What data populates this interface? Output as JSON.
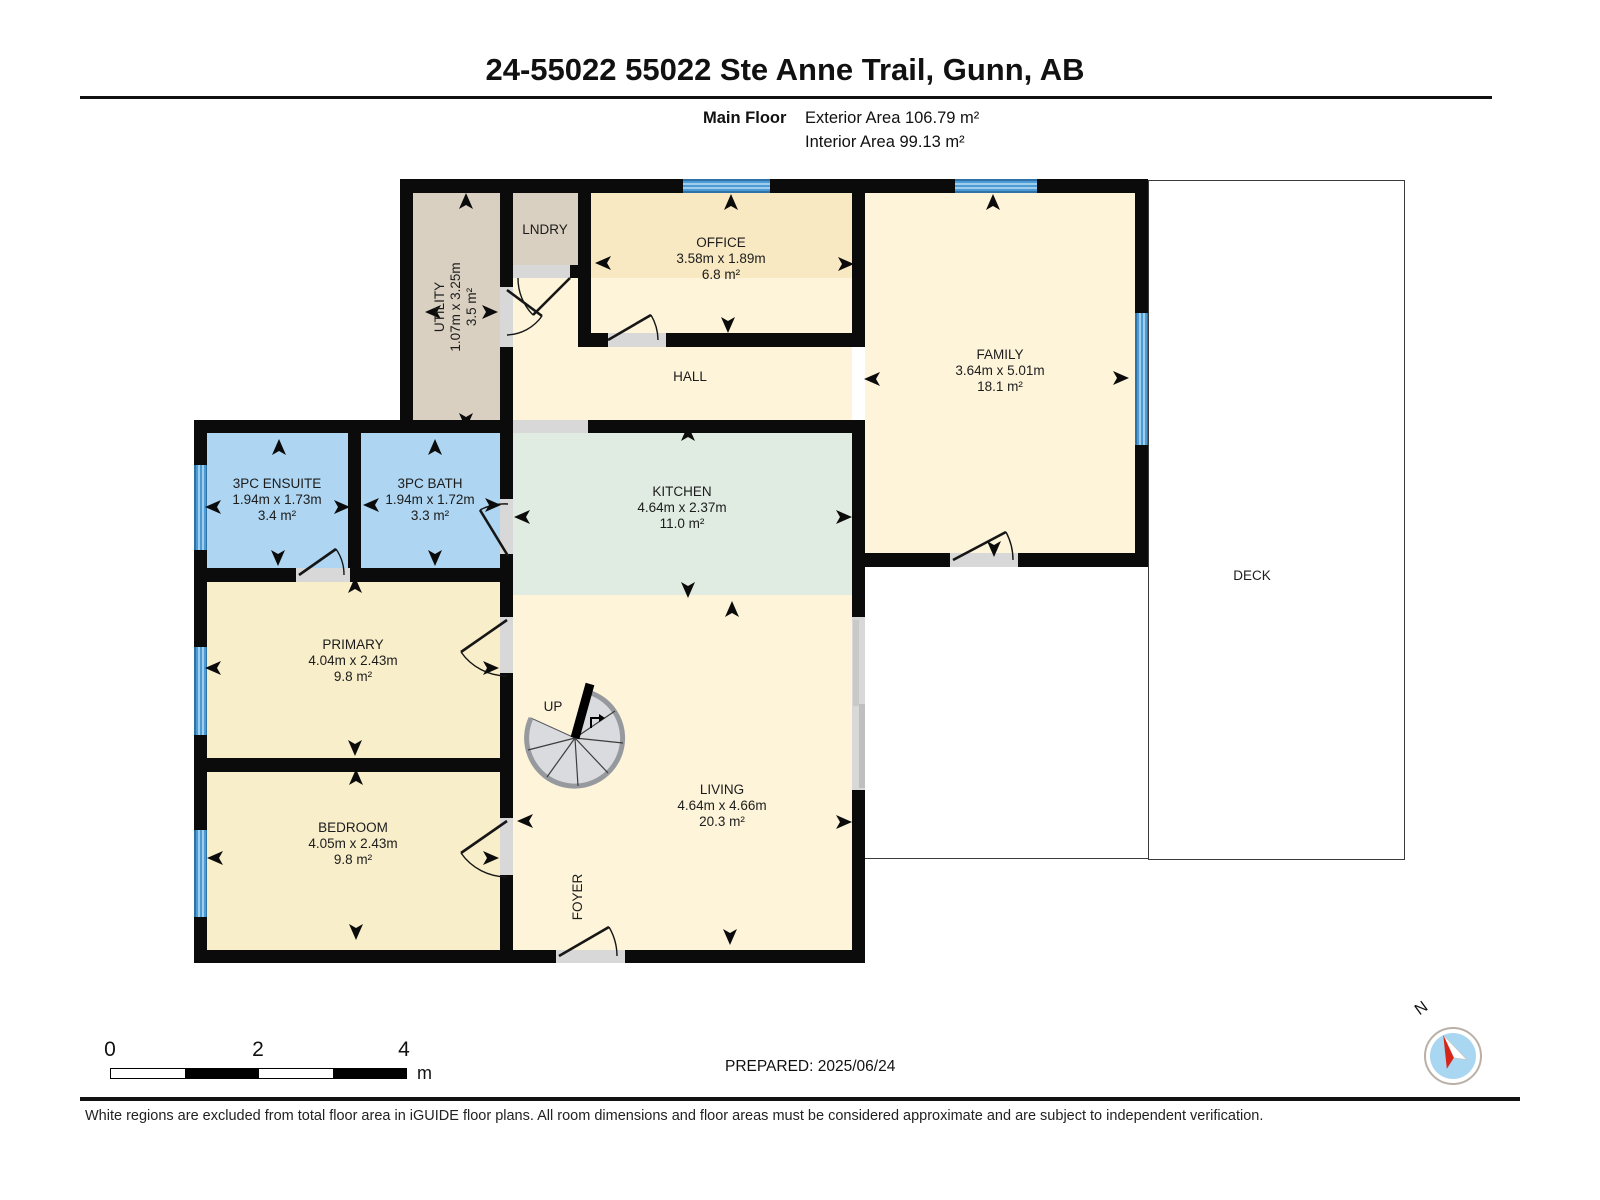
{
  "header": {
    "title": "24-55022 55022 Ste Anne Trail, Gunn, AB",
    "floor_label": "Main Floor",
    "exterior_area_label": "Exterior Area 106.79 m²",
    "interior_area_label": "Interior Area 99.13 m²"
  },
  "rooms": {
    "utility": {
      "name": "UTILITY",
      "dims": "1.07m x 3.25m",
      "area": "3.5 m²"
    },
    "laundry": {
      "name": "LNDRY"
    },
    "office": {
      "name": "OFFICE",
      "dims": "3.58m x 1.89m",
      "area": "6.8 m²"
    },
    "hall": {
      "name": "HALL"
    },
    "family": {
      "name": "FAMILY",
      "dims": "3.64m x 5.01m",
      "area": "18.1 m²"
    },
    "kitchen": {
      "name": "KITCHEN",
      "dims": "4.64m x 2.37m",
      "area": "11.0 m²"
    },
    "ensuite": {
      "name": "3PC ENSUITE",
      "dims": "1.94m x 1.73m",
      "area": "3.4 m²"
    },
    "bath": {
      "name": "3PC BATH",
      "dims": "1.94m x 1.72m",
      "area": "3.3 m²"
    },
    "primary": {
      "name": "PRIMARY",
      "dims": "4.04m x 2.43m",
      "area": "9.8 m²"
    },
    "bedroom": {
      "name": "BEDROOM",
      "dims": "4.05m x 2.43m",
      "area": "9.8 m²"
    },
    "living": {
      "name": "LIVING",
      "dims": "4.64m x 4.66m",
      "area": "20.3 m²"
    },
    "foyer": {
      "name": "FOYER"
    },
    "deck": {
      "name": "DECK"
    },
    "stairs": {
      "label": "UP"
    }
  },
  "scale_bar": {
    "tick_0": "0",
    "tick_2": "2",
    "tick_4": "4",
    "unit": "m"
  },
  "prepared_label": "PREPARED: 2025/06/24",
  "compass": {
    "label": "N"
  },
  "footer_note": "White regions are excluded from total floor area in iGUIDE floor plans. All room dimensions and floor areas must be considered approximate and are subject to independent verification.",
  "colors": {
    "wall": "#0b0b0b",
    "room_cream": "#fdf4da",
    "room_warm": "#f9eeca",
    "room_office": "#f8e9c2",
    "room_tan": "#d9d0c1",
    "room_bath_blue": "#aed6f2",
    "room_kitchen_mint": "#e0ece2",
    "window_blue": "#4d9bd5",
    "door_opening": "#d8d8d8",
    "stair_gray": "#d9dbde",
    "compass_red": "#d62418",
    "compass_blue": "#a9d6f0"
  }
}
